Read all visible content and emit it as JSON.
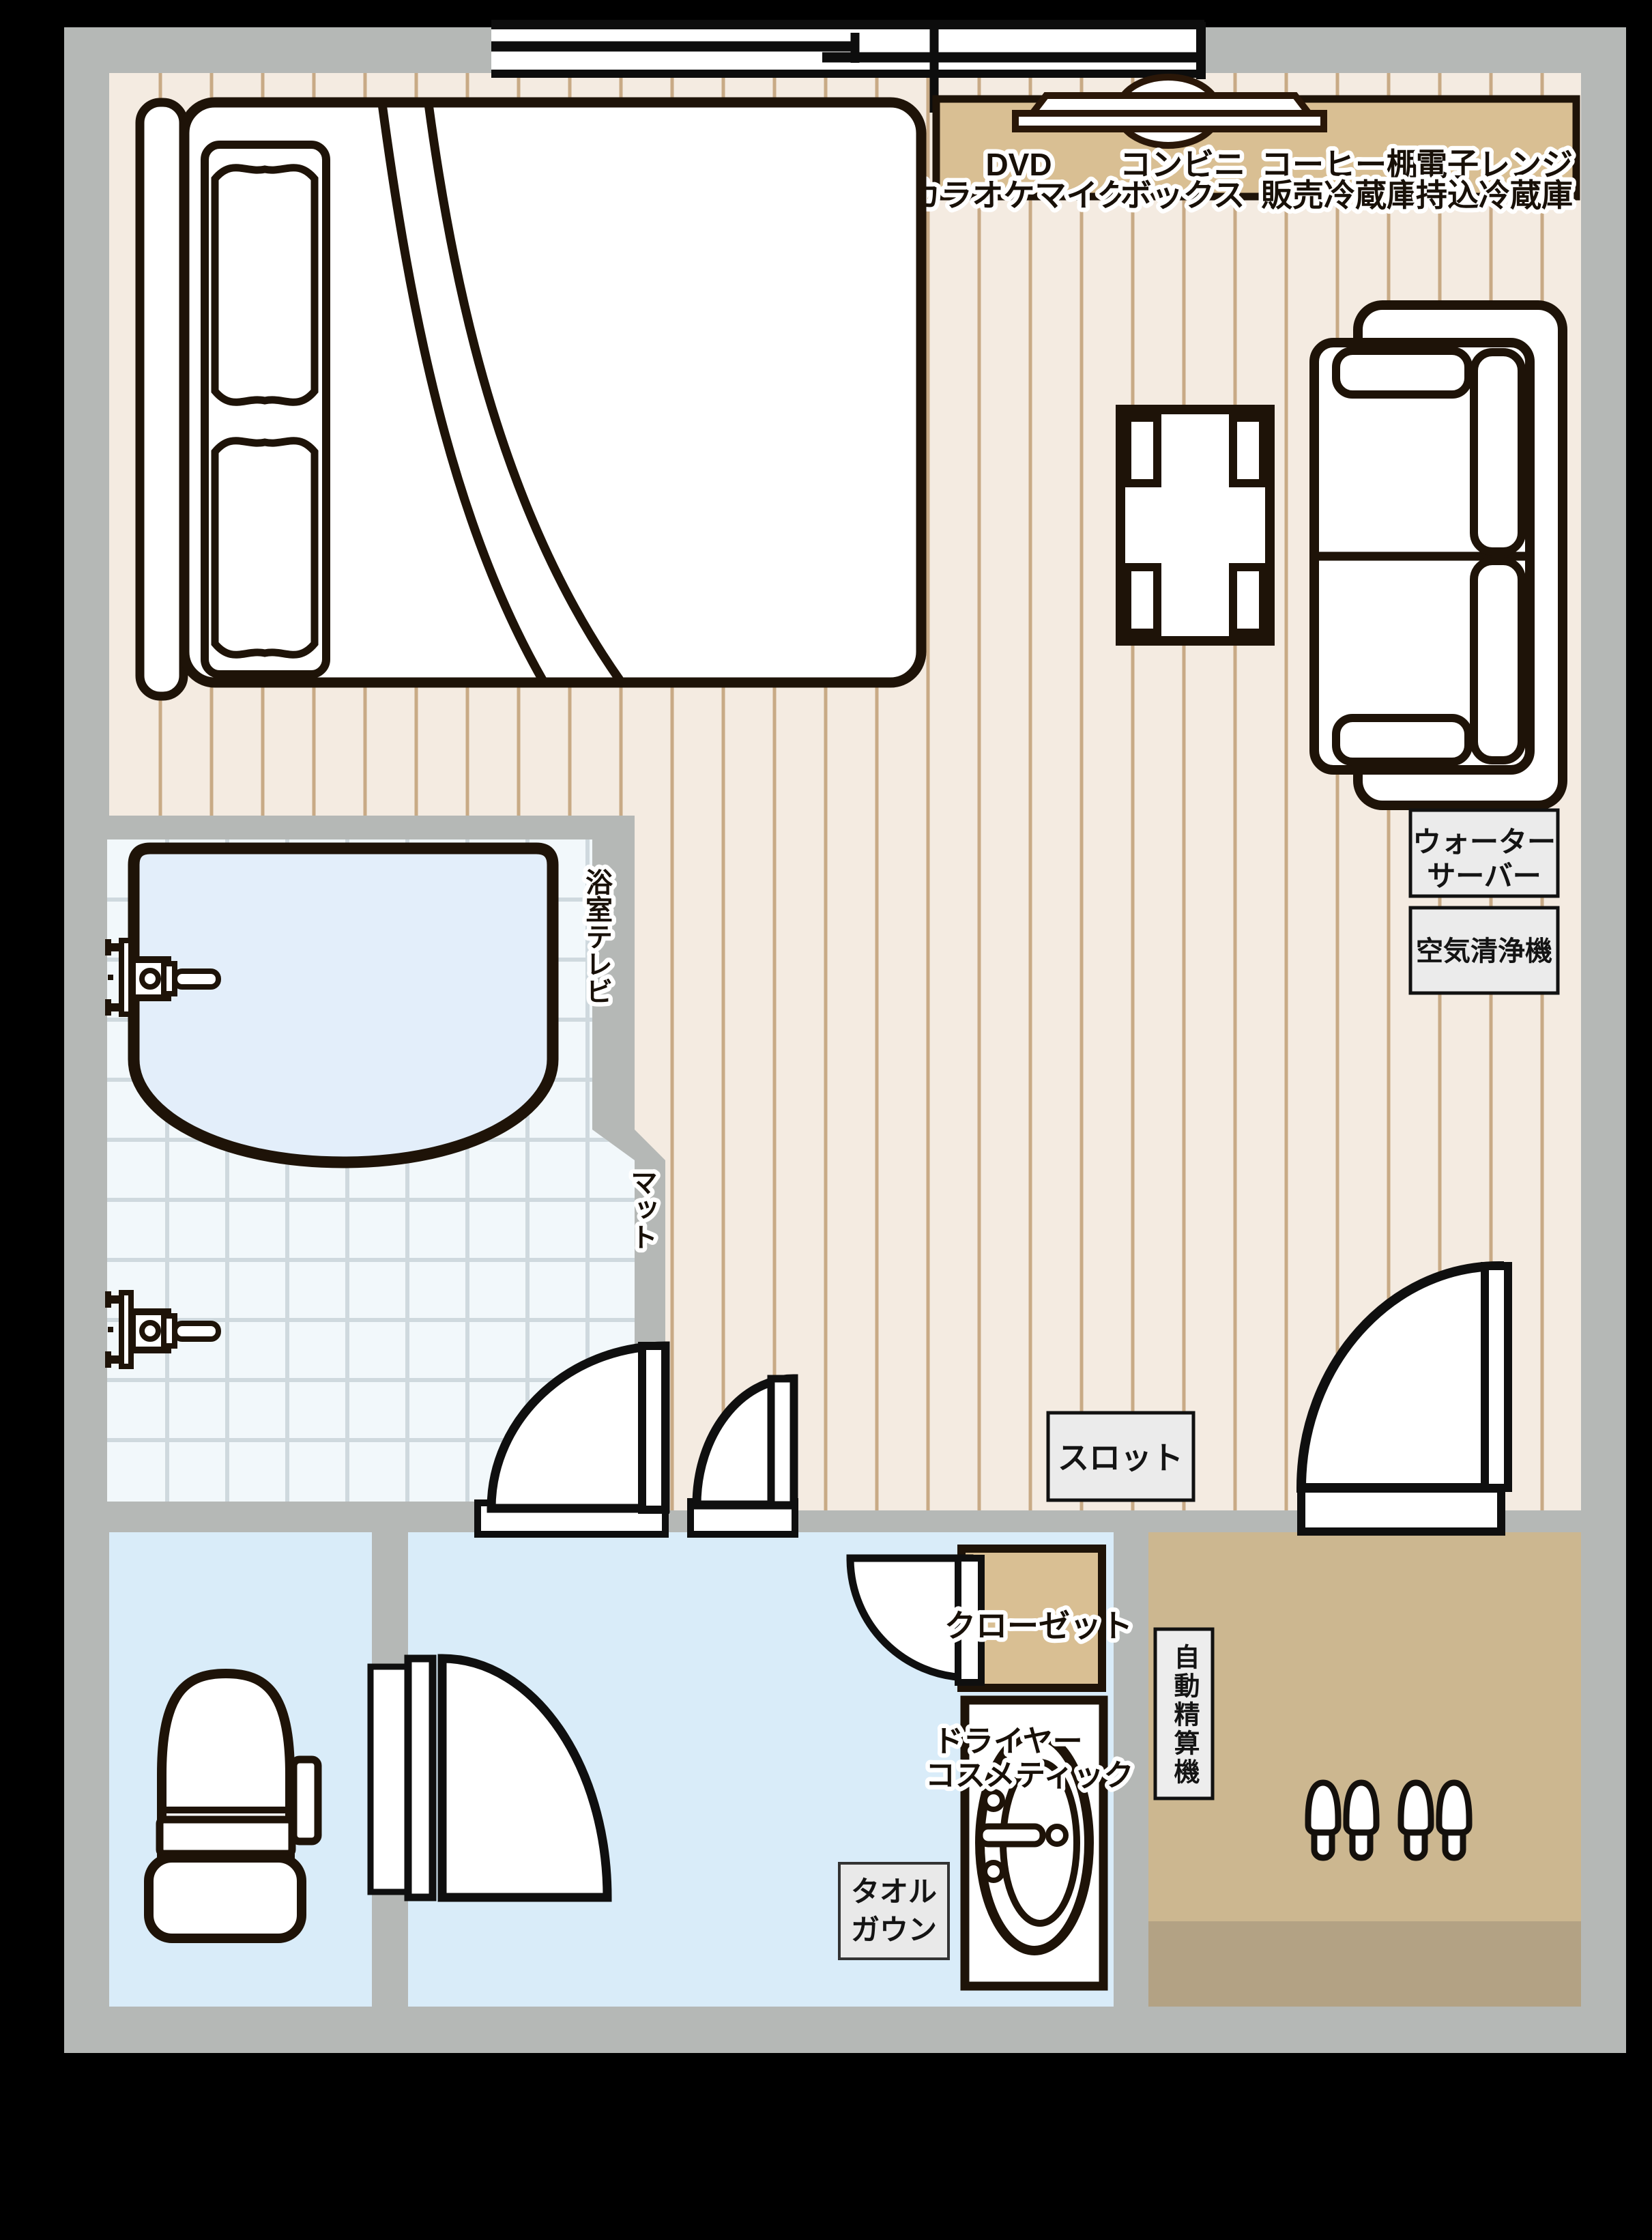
{
  "title": "ホテル客室 間取り図",
  "colors": {
    "background": "#000000",
    "wall": "#b5b8b6",
    "wood_floor": "#f4ebe1",
    "plank_line": "#c8aa85",
    "counter_wood": "#d9bf93",
    "entrance_floor": "#ccb790",
    "entrance_step": "#b3a284",
    "tile_floor": "#f2f8fb",
    "tile_grid": "#cfd9de",
    "tub_water": "#e3eefa",
    "wet_room_floor": "#d9ecf9",
    "line": "#1e1308",
    "label_box": "#ebebeb"
  },
  "labels": {
    "counter": [
      {
        "top": "DVD",
        "bottom": "カラオケマイク"
      },
      {
        "top": "コンビニ",
        "bottom": "ボックス"
      },
      {
        "top": "コーヒー棚",
        "bottom": "販売冷蔵庫"
      },
      {
        "top": "電子レンジ",
        "bottom": "持込冷蔵庫"
      }
    ],
    "water_server": {
      "line1": "ウォーター",
      "line2": "サーバー"
    },
    "air_purifier": "空気清浄機",
    "bath_tv": "浴室テレビ",
    "mat": "マット",
    "slot": "スロット",
    "closet": "クローゼット",
    "dryer": {
      "line1": "ドライヤー",
      "line2": "コスメティック"
    },
    "towel": {
      "line1": "タオル",
      "line2": "ガウン"
    },
    "auto_checkout": "自動精算機"
  }
}
